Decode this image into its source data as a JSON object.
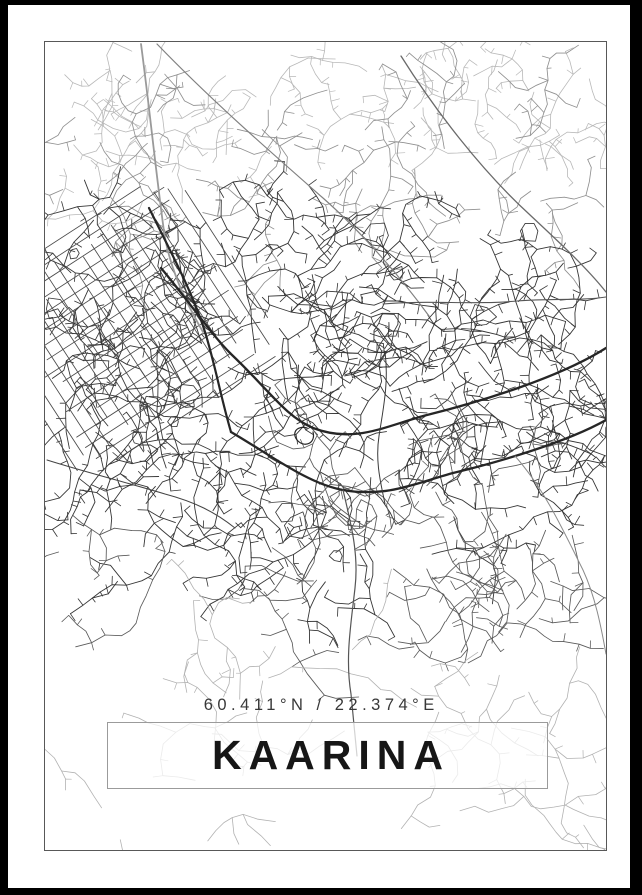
{
  "poster": {
    "title": "KAARINA",
    "coordinates_label": "60.411°N / 22.374°E",
    "colors": {
      "photo_frame": "#000000",
      "matte": "#ffffff",
      "map_border_line": "#585858",
      "title_text": "#161616",
      "coordinates_text": "#383838",
      "title_box_border": "#9b9b9b",
      "road_dark": "#262626",
      "road_mid": "#555555",
      "road_light": "#b2b2b2"
    }
  },
  "map": {
    "seed": 421137,
    "width": 561,
    "height": 808,
    "empty_zones": [
      {
        "x": 90,
        "y": 540,
        "r": 70
      },
      {
        "x": 255,
        "y": 625,
        "r": 50
      },
      {
        "x": 300,
        "y": 745,
        "r": 85
      },
      {
        "x": 100,
        "y": 720,
        "r": 70
      },
      {
        "x": 490,
        "y": 55,
        "r": 45
      }
    ],
    "grid": {
      "cx": 82,
      "cy": 282,
      "angleDeg": -33,
      "spacing": 13.5,
      "countA": 9,
      "countB": 8,
      "halfA": 112,
      "halfB": 102,
      "color": "#4a4a4a",
      "width": 0.85
    },
    "minor_bands": [
      {
        "count": 30,
        "x": [
          0,
          561
        ],
        "y": [
          2,
          130
        ],
        "segs": [
          4,
          11
        ],
        "step": [
          7,
          15
        ],
        "stub": 0.35,
        "branch": 0.2,
        "color": "#b8b8b8",
        "width": 0.8
      },
      {
        "count": 24,
        "x": [
          0,
          561
        ],
        "y": [
          60,
          200
        ],
        "segs": [
          4,
          12
        ],
        "step": [
          8,
          16
        ],
        "stub": 0.4,
        "branch": 0.25,
        "color": "#909090",
        "width": 0.85
      },
      {
        "count": 88,
        "x": [
          0,
          561
        ],
        "y": [
          170,
          470
        ],
        "segs": [
          5,
          14
        ],
        "step": [
          8,
          17
        ],
        "stub": 0.55,
        "branch": 0.3,
        "color": "#363636",
        "width": 0.9
      },
      {
        "count": 30,
        "x": [
          0,
          561
        ],
        "y": [
          440,
          620
        ],
        "segs": [
          4,
          12
        ],
        "step": [
          9,
          18
        ],
        "stub": 0.35,
        "branch": 0.25,
        "color": "#5a5a5a",
        "width": 0.85
      },
      {
        "count": 20,
        "x": [
          0,
          561
        ],
        "y": [
          600,
          806
        ],
        "segs": [
          4,
          12
        ],
        "step": [
          9,
          18
        ],
        "stub": 0.2,
        "branch": 0.2,
        "color": "#b2b2b2",
        "width": 0.8
      }
    ],
    "blobs": {
      "count": 16,
      "y": [
        160,
        520
      ],
      "rmin": 5,
      "rmax": 13,
      "color": "#3a3a3a",
      "width": 0.85
    },
    "major_roads": [
      {
        "name": "rail-nw",
        "d": "M96,2 C104,62 110,122 118,182 C122,218 136,252 158,290",
        "color": "#9a9a9a",
        "width": 1.8
      },
      {
        "name": "diagonal-top",
        "d": "M112,2 C168,60 228,112 278,156 C312,186 352,230 384,274",
        "color": "#808080",
        "width": 1.2
      },
      {
        "name": "diagonal-ne",
        "d": "M356,14 C390,68 436,128 484,172 C514,200 542,226 561,250",
        "color": "#6a6a6a",
        "width": 1.3
      },
      {
        "name": "approach-nw",
        "d": "M104,166 C128,214 148,252 160,290 C170,322 176,356 186,390",
        "color": "#262626",
        "width": 2.2
      },
      {
        "name": "highway-upper",
        "d": "M116,226 C146,262 166,292 186,312 C224,348 240,374 268,386 C310,402 340,384 382,373 C434,360 514,336 561,306",
        "color": "#262626",
        "width": 2.3
      },
      {
        "name": "highway-lower",
        "d": "M186,390 C230,416 264,442 298,448 C342,456 374,440 408,431 C454,420 522,400 561,378",
        "color": "#262626",
        "width": 2.3
      },
      {
        "name": "junction-loop",
        "d": "M262,386 c-11,-3 -16,6 -9,13 c7,7 18,2 15,-9",
        "color": "#262626",
        "width": 1.2
      },
      {
        "name": "south-road",
        "d": "M298,448 C306,482 314,512 310,546 C306,582 300,616 306,652 C308,672 310,692 312,714",
        "color": "#555555",
        "width": 1.2
      },
      {
        "name": "east-road",
        "d": "M338,262 C382,258 430,263 472,259 C506,256 536,259 561,255",
        "color": "#555555",
        "width": 1.1
      },
      {
        "name": "se-branch",
        "d": "M470,414 C500,448 518,488 538,528 C550,554 556,584 561,612",
        "color": "#8a8a8a",
        "width": 1.0
      },
      {
        "name": "west-coast-road",
        "d": "M2,418 C40,430 80,440 120,452 C150,460 170,470 190,486",
        "color": "#444444",
        "width": 1.0
      },
      {
        "name": "mid-vertical",
        "d": "M340,310 C344,340 338,368 334,394 C330,420 336,442 340,462",
        "color": "#3a3a3a",
        "width": 1.0
      }
    ]
  }
}
